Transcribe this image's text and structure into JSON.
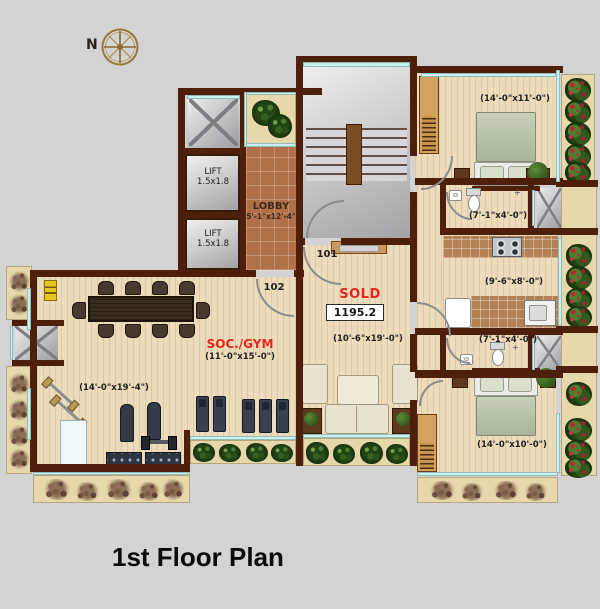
{
  "title": "1st Floor Plan",
  "compass_label": "N",
  "lift": {
    "label": "LIFT",
    "size": "1.5x1.8"
  },
  "lobby": {
    "label": "LOBBY",
    "size": "(5'-1\"x12'-4\")"
  },
  "doors": {
    "d101": "101",
    "d102": "102"
  },
  "sold": {
    "label": "SOLD",
    "area": "1195.2"
  },
  "rooms": {
    "living": {
      "size": "(10'-6\"x19'-0\")"
    },
    "soc_gym": {
      "label": "SOC./GYM",
      "size": "(11'-0\"x15'-0\")"
    },
    "gym_hall": {
      "size": "(14'-0\"x19'-4\")"
    },
    "bedroom_top": {
      "size": "(14'-0\"x11'-0\")"
    },
    "bath_top": {
      "size": "(7'-1\"x4'-0\")"
    },
    "kitchen": {
      "size": "(9'-6\"x8'-0\")"
    },
    "bath_bottom": {
      "size": "(7'-1\"x4'-0\")"
    },
    "bedroom_bottom": {
      "size": "(14'-0\"x10'-0\")"
    }
  },
  "colors": {
    "wall": "#4e1f0a",
    "floor": "#ecdcbc",
    "lobby_floor": "#b27049",
    "balcony_glass": "#c9f2ef",
    "sold_red": "#e8251c",
    "compass_gold": "#9a7a3a"
  }
}
